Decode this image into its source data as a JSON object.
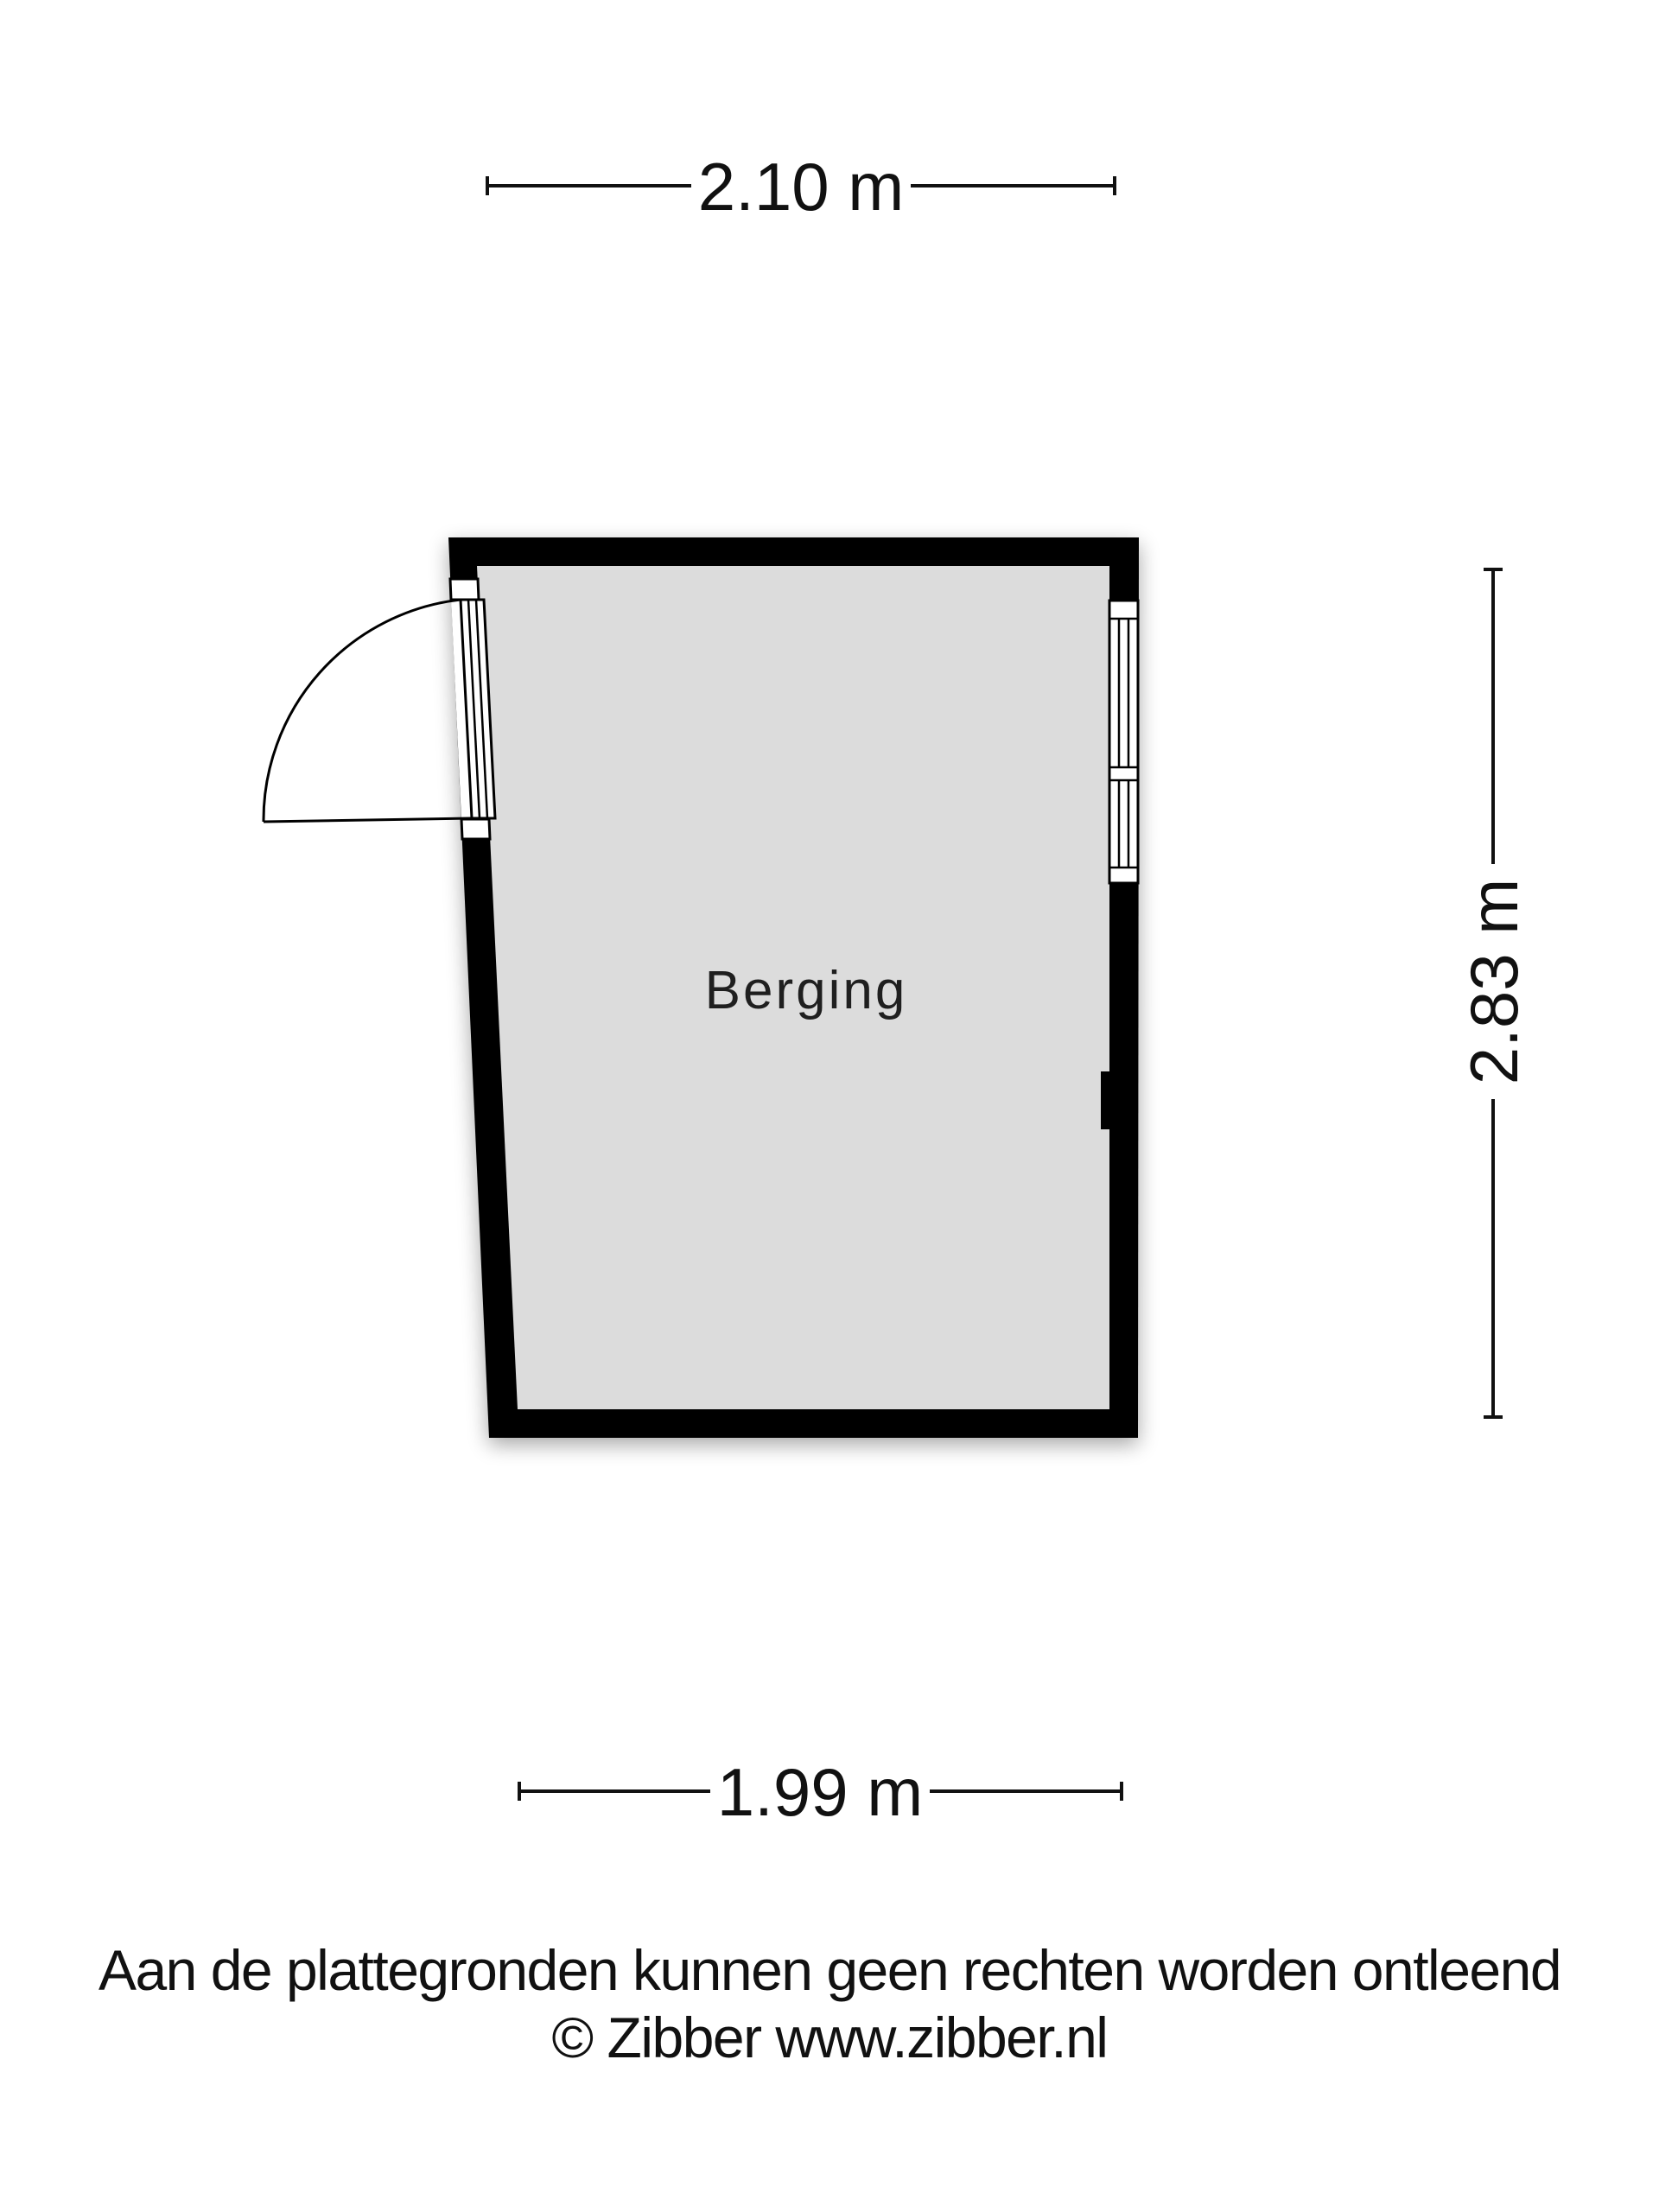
{
  "floor_plan": {
    "room": {
      "label": "Berging"
    },
    "dimensions": {
      "width_top": "2.10 m",
      "height_right": "2.83 m",
      "width_bottom": "1.99 m"
    },
    "colors": {
      "wall": "#000000",
      "floor": "#dcdcdc"
    }
  },
  "footer": {
    "disclaimer": "Aan de plattegronden kunnen geen rechten worden ontleend",
    "copyright": "© Zibber www.zibber.nl"
  }
}
